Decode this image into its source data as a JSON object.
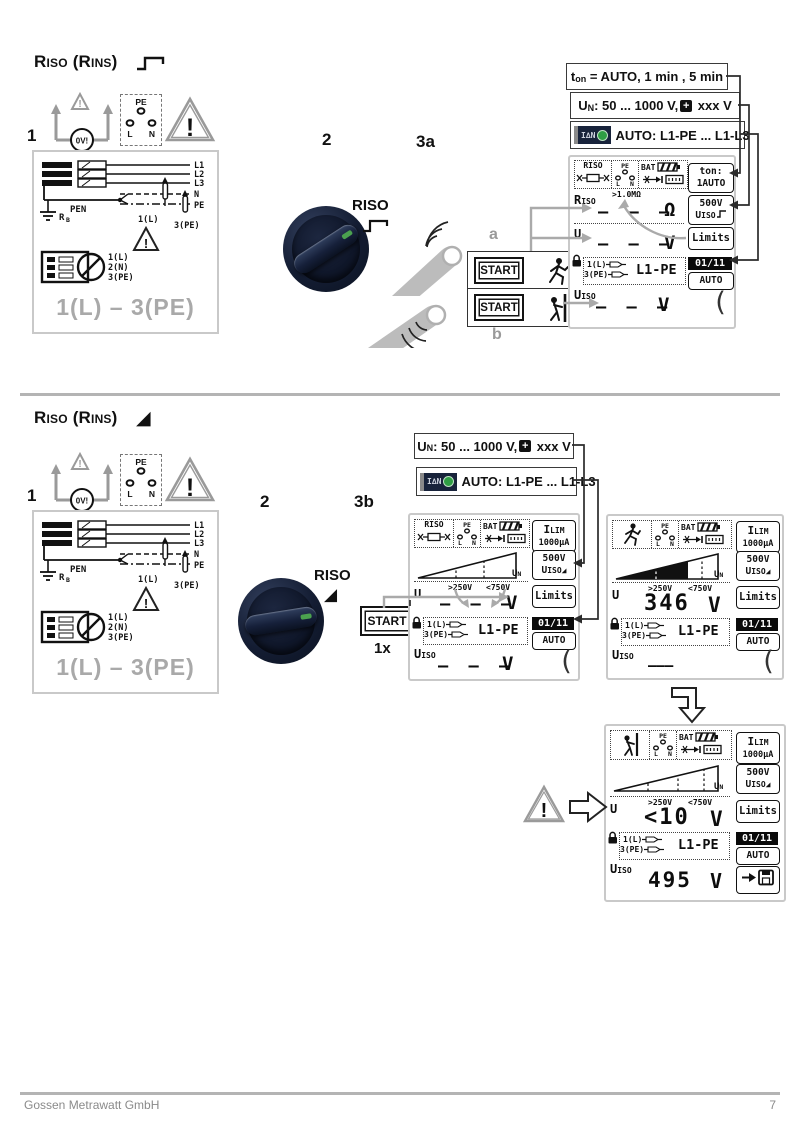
{
  "footer": {
    "company": "Gossen Metrawatt GmbH",
    "page_number": "7"
  },
  "s1": {
    "steps": {
      "n1": "1",
      "n2": "2",
      "n3": "3a"
    },
    "title": {
      "r": "R",
      "iso": "ISO",
      "mid": " (R",
      "ins": "INS",
      "end": ")"
    },
    "ton": {
      "t": "t",
      "on": "on",
      "rest": " = AUTO, 1 min , 5 min"
    },
    "un": {
      "u": "U",
      "n": "N",
      "mid": ": 50 ... 1000 V,",
      "plus": "+",
      "rest": " xxx V"
    },
    "auto": {
      "icon": "I∆N",
      "text": "AUTO: L1-PE ... L1-L3"
    },
    "knob": "RISO",
    "start_a": "START",
    "start_b": "START",
    "label_a": "a",
    "label_b": "b"
  },
  "s2": {
    "steps": {
      "n1": "1",
      "n2": "2",
      "n3": "3b"
    },
    "title": {
      "r": "R",
      "iso": "ISO",
      "mid": " (R",
      "ins": "INS",
      "end": ")"
    },
    "un": {
      "u": "U",
      "n": "N",
      "mid": ": 50 ... 1000 V,",
      "plus": "+",
      "rest": " xxx V"
    },
    "auto": {
      "icon": "I∆N",
      "text": "AUTO: L1-PE ... L1-L3"
    },
    "knob": "RISO",
    "start": "START",
    "times": "1x"
  },
  "wiring": {
    "l1": "L1",
    "l2": "L2",
    "l3": "L3",
    "n": "N",
    "pe": "PE",
    "pen": "PEN",
    "rb": "R",
    "rb_sub": "B",
    "probe1": "1(L)",
    "probe3": "3(PE)",
    "plug1": "1(L)",
    "plug2": "2(N)",
    "plug3": "3(PE)",
    "caption": "1(L) – 3(PE)",
    "bang": "!"
  },
  "sym": {
    "ov": "0V!",
    "bang": "!",
    "pe": "PE",
    "l": "L",
    "n": "N"
  },
  "lcd3a": {
    "riso": "RISO",
    "bat": "BAT",
    "pe": "PE",
    "l": "L",
    "n": "N",
    "sk1a": "ton:",
    "sk1b": "1AUTO",
    "sk2a": "500V",
    "sk2b_u": "U",
    "sk2b_sub": "ISO",
    "sk3": "Limits",
    "sk4": "01/11",
    "sk5": "AUTO",
    "r": "R",
    "r_sub": "ISO",
    "ann": ">1.0MΩ",
    "r_val": "– – –",
    "r_unit": "Ω",
    "u": "U",
    "u_val": "– – –",
    "u_unit": "V",
    "p1": "1(L)",
    "p3": "3(PE)",
    "target": "L1-PE",
    "ui": "U",
    "ui_sub": "ISO",
    "ui_val": "– – –",
    "ui_unit": "V",
    "bracket": "("
  },
  "lcd3b": {
    "riso": "RISO",
    "bat": "BAT",
    "pe": "PE",
    "l": "L",
    "n": "N",
    "sk1a_i": "I",
    "sk1a_sub": "LIM",
    "sk1b": "1000µA",
    "sk2a": "500V",
    "sk2b_u": "U",
    "sk2b_sub": "ISO",
    "sk3": "Limits",
    "sk4": "01/11",
    "sk5": "AUTO",
    "un_u": "U",
    "un_sub": "N",
    "th1": ">250V",
    "th2": "<750V",
    "u": "U",
    "u_val": "– – –",
    "u_unit": "V",
    "p1": "1(L)",
    "p3": "3(PE)",
    "target": "L1-PE",
    "ui": "U",
    "ui_sub": "ISO",
    "ui_val": "– – –",
    "ui_unit": "V",
    "bracket": "("
  },
  "lcd346": {
    "bat": "BAT",
    "pe": "PE",
    "l": "L",
    "n": "N",
    "sk1a_i": "I",
    "sk1a_sub": "LIM",
    "sk1b": "1000µA",
    "sk2a": "500V",
    "sk2b_u": "U",
    "sk2b_sub": "ISO",
    "sk3": "Limits",
    "sk4": "01/11",
    "sk5": "AUTO",
    "un_u": "U",
    "un_sub": "N",
    "th1": ">250V",
    "th2": "<750V",
    "u": "U",
    "u_val": "346",
    "u_unit": "V",
    "p1": "1(L)",
    "p3": "3(PE)",
    "target": "L1-PE",
    "ui": "U",
    "ui_sub": "ISO",
    "ui_val": "———",
    "bracket": "("
  },
  "lcdf": {
    "bat": "BAT",
    "pe": "PE",
    "l": "L",
    "n": "N",
    "sk1a_i": "I",
    "sk1a_sub": "LIM",
    "sk1b": "1000µA",
    "sk2a": "500V",
    "sk2b_u": "U",
    "sk2b_sub": "ISO",
    "sk3": "Limits",
    "sk4": "01/11",
    "sk5": "AUTO",
    "un_u": "U",
    "un_sub": "N",
    "th1": ">250V",
    "th2": "<750V",
    "u": "U",
    "u_val": "<10",
    "u_unit": "V",
    "p1": "1(L)",
    "p3": "3(PE)",
    "target": "L1-PE",
    "ui": "U",
    "ui_sub": "ISO",
    "ui_val": "495",
    "ui_unit": "V"
  }
}
